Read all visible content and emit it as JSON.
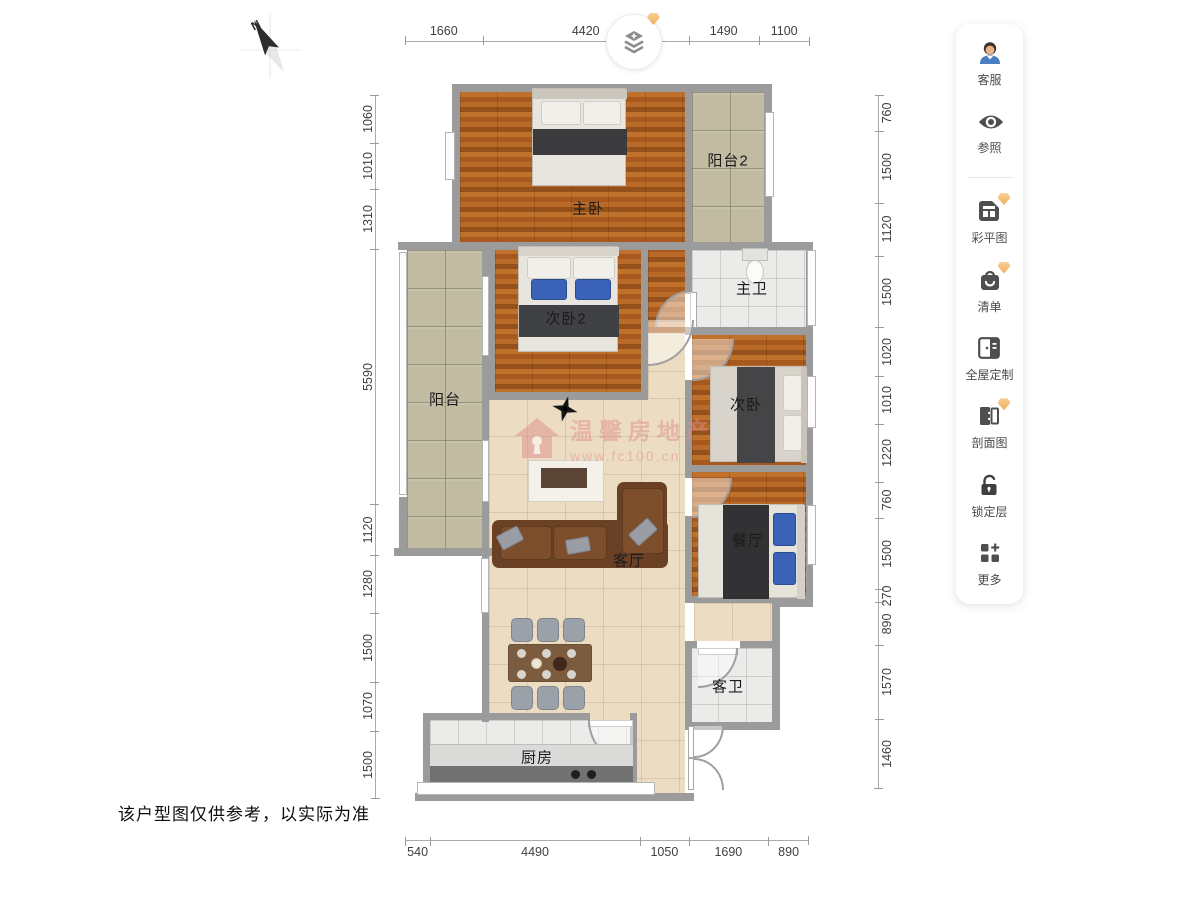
{
  "header": {
    "compass_label": "N"
  },
  "toolbar": {
    "items": [
      {
        "label": "客服",
        "icon": "support-agent-icon",
        "premium": false
      },
      {
        "label": "参照",
        "icon": "eye-icon",
        "premium": false
      },
      {
        "label": "彩平图",
        "icon": "color-plan-icon",
        "premium": true
      },
      {
        "label": "清单",
        "icon": "shopping-bag-icon",
        "premium": true
      },
      {
        "label": "全屋定制",
        "icon": "cabinet-door-icon",
        "premium": false
      },
      {
        "label": "剖面图",
        "icon": "section-view-icon",
        "premium": true
      },
      {
        "label": "锁定层",
        "icon": "unlocked-padlock-icon",
        "premium": false
      },
      {
        "label": "更多",
        "icon": "more-grid-icon",
        "premium": false
      }
    ]
  },
  "layers_button": {
    "icon": "layers-icon",
    "premium": true
  },
  "dimensions": {
    "top": [
      1660,
      4420,
      1490,
      1100
    ],
    "bottom": [
      540,
      4490,
      1050,
      1690,
      890
    ],
    "left": [
      1060,
      1010,
      1310,
      5590,
      1120,
      1280,
      1500,
      1070,
      1500
    ],
    "right": [
      760,
      1500,
      1120,
      1500,
      1020,
      1010,
      1220,
      760,
      1500,
      270,
      890,
      1570,
      1460
    ]
  },
  "rooms": {
    "master_bedroom": "主卧",
    "balcony2": "阳台2",
    "master_bath": "主卫",
    "bedroom2": "次卧2",
    "balcony": "阳台",
    "bedroom": "次卧",
    "dining": "餐厅",
    "living": "客厅",
    "guest_bath": "客卫",
    "kitchen": "厨房"
  },
  "watermark": {
    "brand": "温馨房地产",
    "url": "www.fc100.cn"
  },
  "disclaimer": "该户型图仅供参考，以实际为准",
  "colors": {
    "wall": "#9b9b9b",
    "wood": "#b2641f",
    "floor_beige": "#ecdcc1",
    "tile_balcony": "#c1bba2",
    "tile_white": "#ebebe9",
    "sofa_brown": "#6a4124",
    "pillow_blue": "#3a62b8",
    "badge_orange": "#f2ae5b",
    "icon_gray": "#4f4f4f",
    "dim_text": "#3f3f3f",
    "watermark_pink": "#e09090"
  }
}
